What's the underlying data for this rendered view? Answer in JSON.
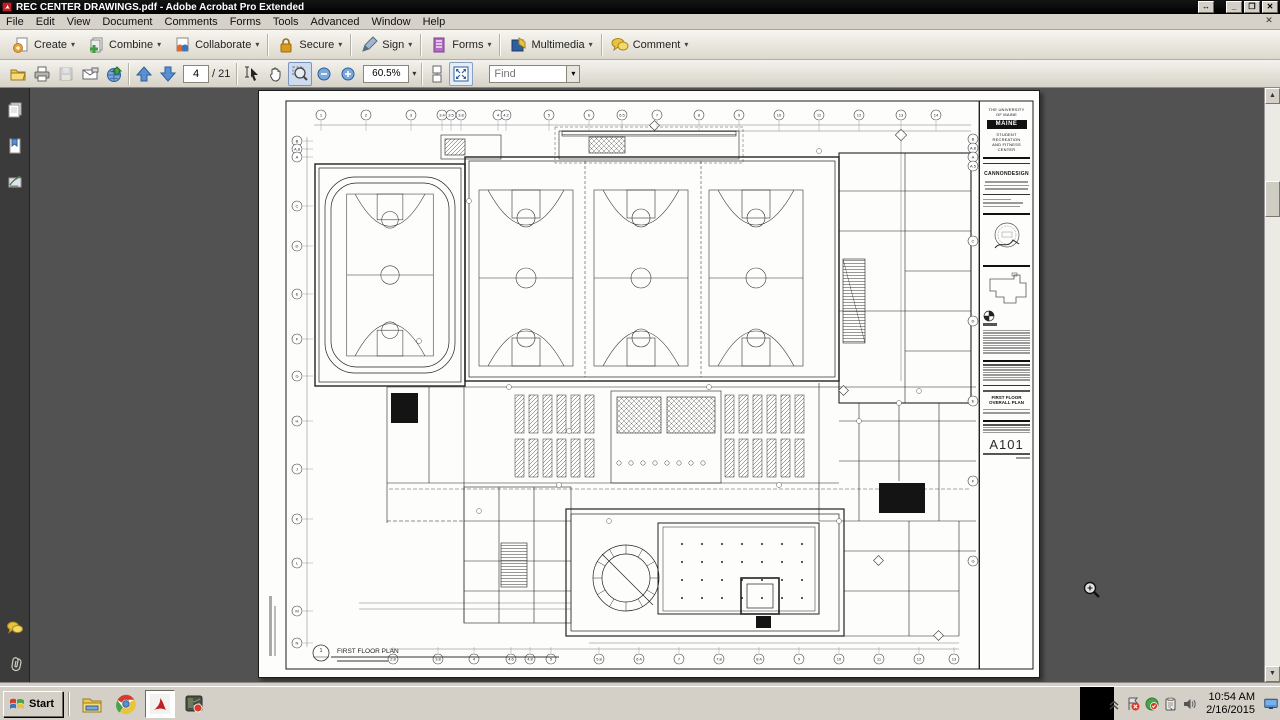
{
  "window": {
    "title": "REC CENTER DRAWINGS.pdf - Adobe Acrobat Pro Extended",
    "controls": {
      "float": "↔",
      "minimize": "_",
      "restore": "❐",
      "close": "✕"
    }
  },
  "icons": {
    "dropdown": "▾",
    "scroll_up": "▲",
    "scroll_down": "▼",
    "doc_close": "✕",
    "chevron_up": "«"
  },
  "menu_bar": {
    "items": [
      "File",
      "Edit",
      "View",
      "Document",
      "Comments",
      "Forms",
      "Tools",
      "Advanced",
      "Window",
      "Help"
    ]
  },
  "task_toolbar": {
    "buttons": [
      {
        "label": "Create"
      },
      {
        "label": "Combine"
      },
      {
        "label": "Collaborate"
      },
      {
        "label": "Secure"
      },
      {
        "label": "Sign"
      },
      {
        "label": "Forms"
      },
      {
        "label": "Multimedia"
      },
      {
        "label": "Comment"
      }
    ]
  },
  "nav_toolbar": {
    "page_value": "4",
    "page_total": "/ 21",
    "zoom_value": "60.5%",
    "find_placeholder": "Find"
  },
  "drawing": {
    "titleblock": {
      "university_line1": "THE UNIVERSITY",
      "university_line2": "OF MAINE",
      "logo": "MAINE",
      "facility_line1": "STUDENT RECREATION",
      "facility_line2": "AND FITNESS CENTER",
      "firm": "CANNONDESIGN",
      "sheet_title_line1": "FIRST FLOOR",
      "sheet_title_line2": "OVERALL PLAN",
      "sheet_number": "A101"
    },
    "plan_callout": {
      "number": "1",
      "label": "FIRST FLOOR PLAN"
    },
    "grid_top": [
      {
        "x": 62,
        "label": "1"
      },
      {
        "x": 107,
        "label": "2"
      },
      {
        "x": 152,
        "label": "3"
      },
      {
        "x": 183,
        "label": "3.4"
      },
      {
        "x": 192,
        "label": "3.5"
      },
      {
        "x": 202,
        "label": "3.8"
      },
      {
        "x": 239,
        "label": "4"
      },
      {
        "x": 247,
        "label": "4.2"
      },
      {
        "x": 290,
        "label": "5"
      },
      {
        "x": 330,
        "label": "6"
      },
      {
        "x": 363,
        "label": "6.5"
      },
      {
        "x": 398,
        "label": "7"
      },
      {
        "x": 440,
        "label": "8"
      },
      {
        "x": 480,
        "label": "9"
      },
      {
        "x": 520,
        "label": "10"
      },
      {
        "x": 560,
        "label": "11"
      },
      {
        "x": 600,
        "label": "12"
      },
      {
        "x": 642,
        "label": "13"
      },
      {
        "x": 677,
        "label": "14"
      }
    ],
    "grid_left": [
      {
        "y": 50,
        "label": "B"
      },
      {
        "y": 58,
        "label": "A.8"
      },
      {
        "y": 66,
        "label": "A"
      },
      {
        "y": 115,
        "label": "C"
      },
      {
        "y": 155,
        "label": "D"
      },
      {
        "y": 203,
        "label": "E"
      },
      {
        "y": 248,
        "label": "F"
      },
      {
        "y": 285,
        "label": "G"
      },
      {
        "y": 330,
        "label": "H"
      },
      {
        "y": 378,
        "label": "J"
      },
      {
        "y": 428,
        "label": "K"
      },
      {
        "y": 472,
        "label": "L"
      },
      {
        "y": 520,
        "label": "M"
      },
      {
        "y": 552,
        "label": "N"
      }
    ],
    "grid_right": [
      {
        "y": 48,
        "label": "B"
      },
      {
        "y": 57,
        "label": "A.8"
      },
      {
        "y": 66,
        "label": "A"
      },
      {
        "y": 75,
        "label": "A.5"
      },
      {
        "y": 150,
        "label": "C"
      },
      {
        "y": 230,
        "label": "D"
      },
      {
        "y": 310,
        "label": "E"
      },
      {
        "y": 390,
        "label": "F"
      },
      {
        "y": 470,
        "label": "G"
      }
    ],
    "grid_bottom": [
      {
        "x": 134,
        "label": "2.8"
      },
      {
        "x": 179,
        "label": "3.8"
      },
      {
        "x": 215,
        "label": "4"
      },
      {
        "x": 252,
        "label": "4.6"
      },
      {
        "x": 271,
        "label": "4.8"
      },
      {
        "x": 292,
        "label": "5"
      },
      {
        "x": 340,
        "label": "5.8"
      },
      {
        "x": 380,
        "label": "6.4"
      },
      {
        "x": 420,
        "label": "7"
      },
      {
        "x": 460,
        "label": "7.8"
      },
      {
        "x": 500,
        "label": "8.4"
      },
      {
        "x": 540,
        "label": "9"
      },
      {
        "x": 580,
        "label": "10"
      },
      {
        "x": 620,
        "label": "11"
      },
      {
        "x": 660,
        "label": "12"
      },
      {
        "x": 695,
        "label": "13"
      }
    ]
  },
  "taskbar": {
    "start_label": "Start",
    "clock_time": "10:54 AM",
    "clock_date": "2/16/2015"
  },
  "colors": {
    "accent_blue": "#3b74bd",
    "acrobat_red": "#c01f25",
    "doc_background": "#525252",
    "navpane_background": "#3b3b3b",
    "classic_gray": "#d4d0c8"
  }
}
